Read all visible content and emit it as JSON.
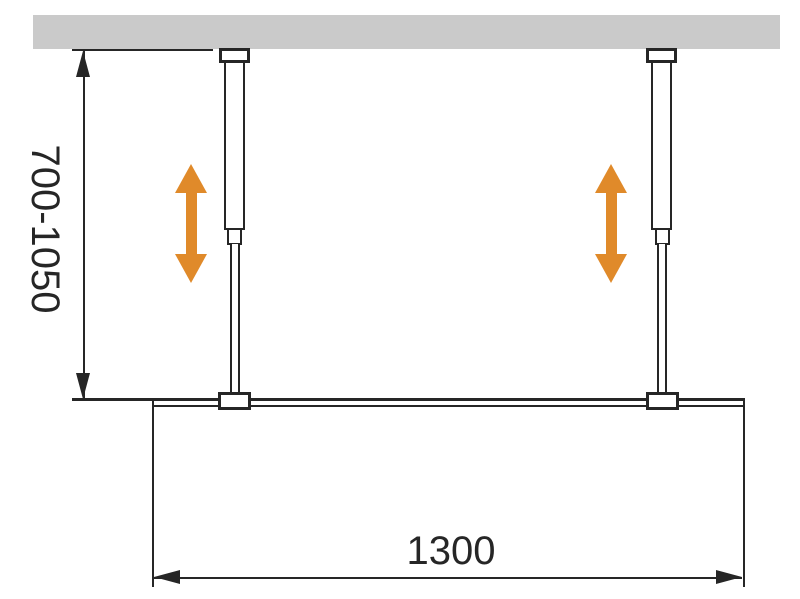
{
  "diagram": {
    "title": "shower-screen-ceiling-support-dimension-drawing",
    "dimensions": {
      "height_range": {
        "label": "700-1050",
        "orientation": "vertical"
      },
      "width": {
        "label": "1300",
        "orientation": "horizontal"
      }
    },
    "colors": {
      "line": "#262626",
      "ceiling": "#cacaca",
      "arrow": "#e08a2a",
      "background": "#ffffff"
    }
  }
}
